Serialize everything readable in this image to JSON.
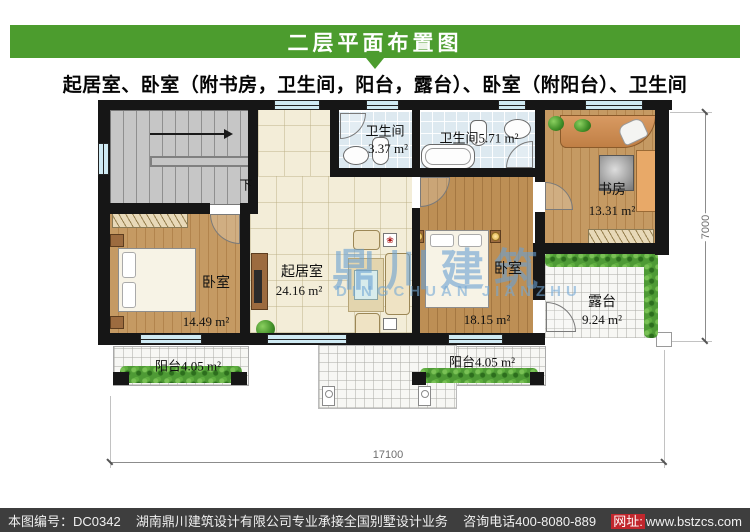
{
  "header": {
    "title": "二层平面布置图"
  },
  "subtitle": "起居室、卧室（附书房，卫生间，阳台，露台）、卧室（附阳台）、卫生间",
  "rooms": {
    "bath_small": {
      "name": "卫生间",
      "area": "3.37 m²"
    },
    "bath_large": {
      "name": "卫生间",
      "area": "5.71 m²"
    },
    "study": {
      "name": "书房",
      "area": "13.31 m²"
    },
    "bedroom_left": {
      "name": "卧室",
      "area": "14.49 m²"
    },
    "living": {
      "name": "起居室",
      "area": "24.16 m²"
    },
    "bedroom_right": {
      "name": "卧室",
      "area": "18.15 m²"
    },
    "terrace": {
      "name": "露台",
      "area": "9.24 m²"
    },
    "balcony_left": {
      "name": "阳台",
      "area": "4.05 m²"
    },
    "balcony_right": {
      "name": "阳台",
      "area": "4.05 m²"
    }
  },
  "stairs": {
    "direction_label": "下"
  },
  "dimensions": {
    "width_mm": "17100",
    "height_mm": "7000"
  },
  "watermark": {
    "cn": "鼎川建筑",
    "en": "DINGCHUAN JIANZHU"
  },
  "footer": {
    "plan_no": "本图编号：DC0342",
    "company": "湖南鼎川建筑设计有限公司专业承接全国别墅设计业务",
    "phone": "咨询电话400-8080-889",
    "url_label": "网址:",
    "url": "www.bstzcs.com"
  },
  "colors": {
    "accent_green": "#4c9c2e",
    "footer_bg": "#3e3e3e",
    "url_red": "#c1272d",
    "window_cyan": "#cfeaf3",
    "watermark_blue": "#69a0d2"
  }
}
